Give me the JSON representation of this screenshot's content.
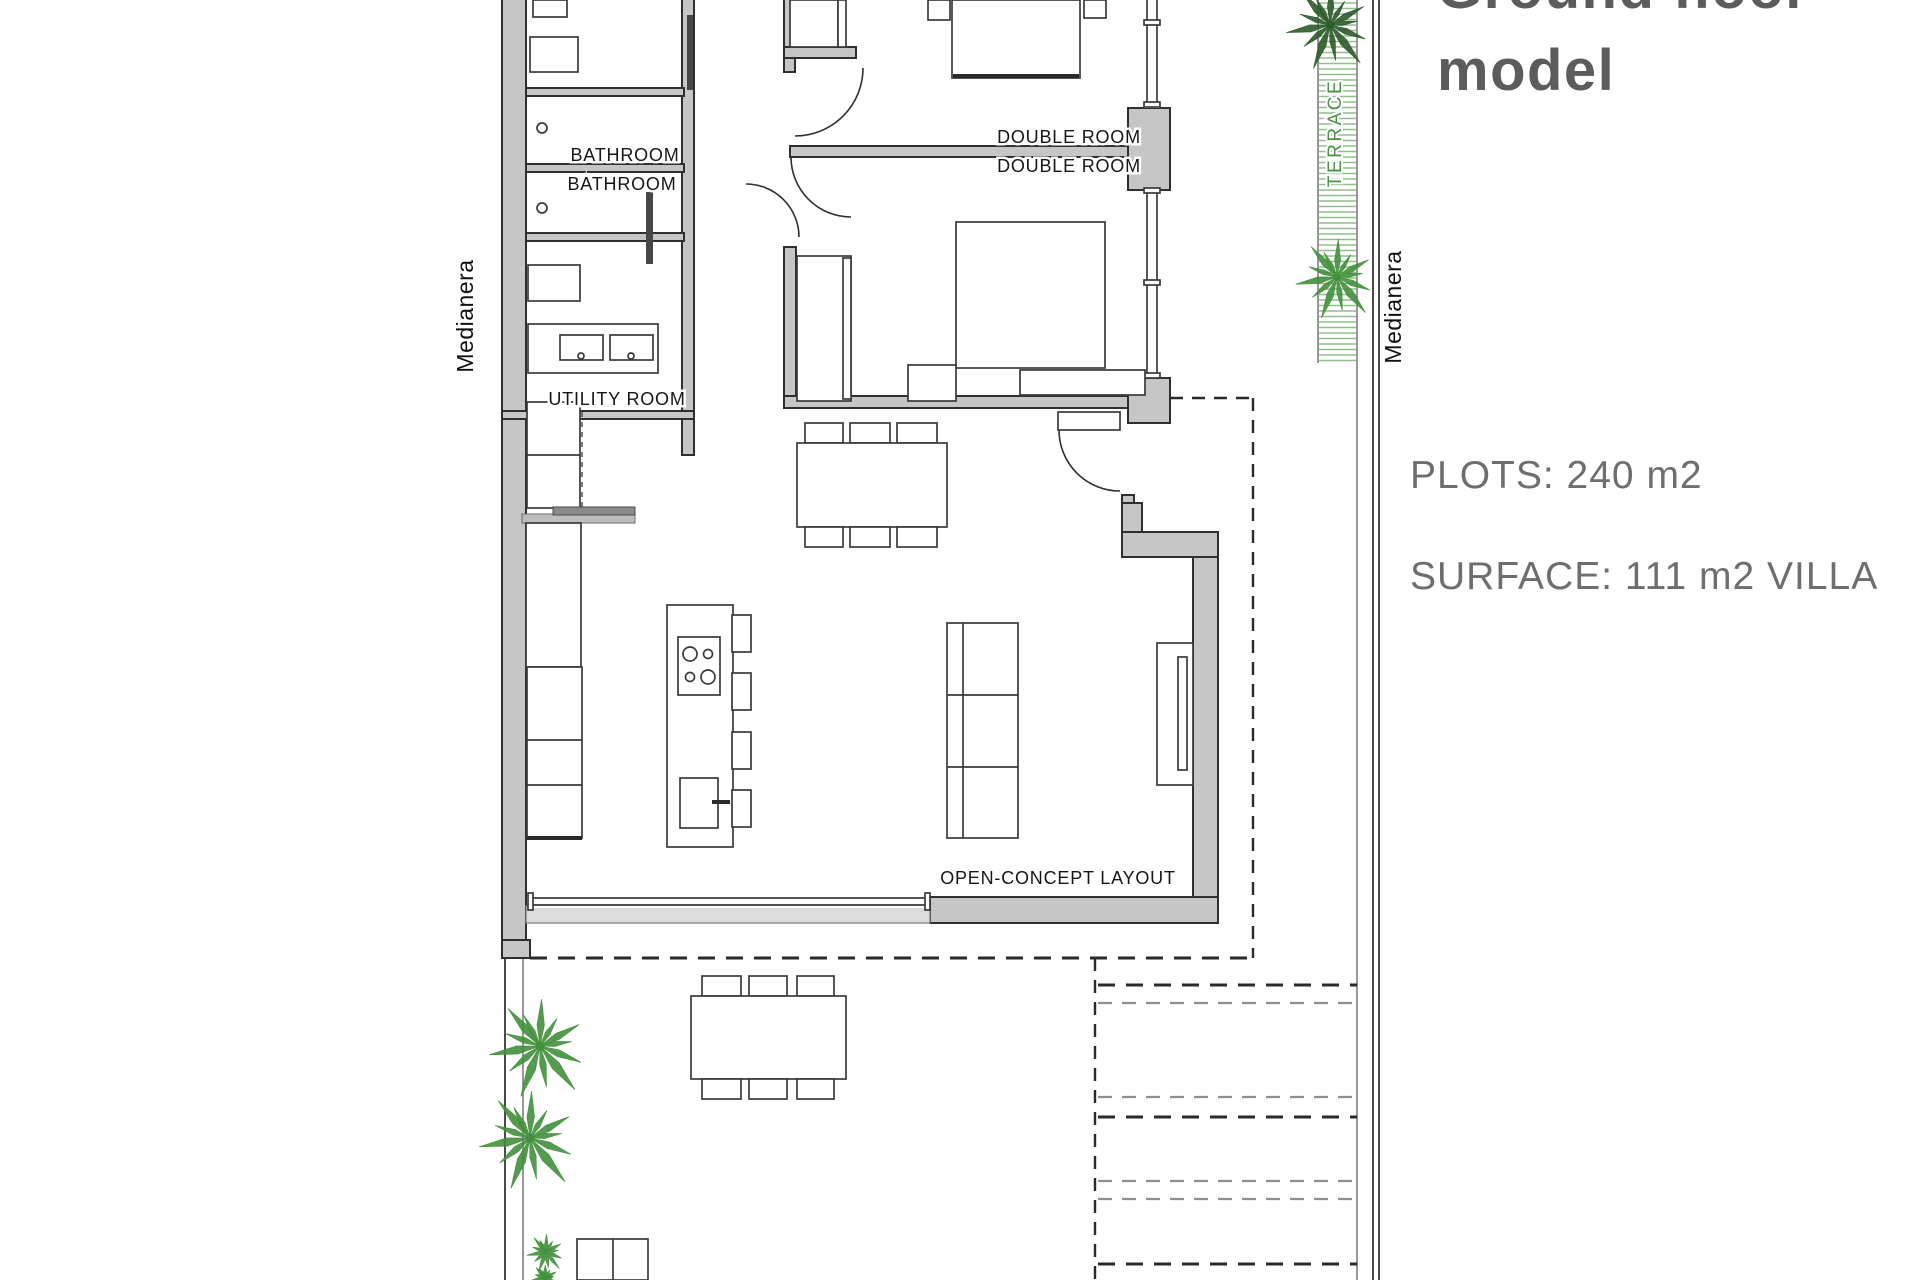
{
  "title": {
    "line1": "Ground floor",
    "line2": "model"
  },
  "info": {
    "plots": "PLOTS: 240 m2",
    "surface": "SURFACE: 111 m2 VILLA",
    "plot_area_m2": 240,
    "villa_surface_m2": 111
  },
  "rooms": {
    "bathroom1": "BATHROOM",
    "bathroom2": "BATHROOM",
    "utility": "UTILITY ROOM",
    "double1": "DOUBLE ROOM",
    "double2": "DOUBLE ROOM",
    "open_concept": "OPEN-CONCEPT LAYOUT",
    "terrace": "TERRACE"
  },
  "boundaries": {
    "left": "Medianera",
    "right": "Medianera"
  },
  "colors": {
    "wall_fill": "#c6c6c6",
    "line": "#2f2f2f",
    "text_gray": "#6e6e6e",
    "title_gray": "#5c5c5c",
    "hatch_green": "#92bd8c",
    "plant_green": "#43903c",
    "plant_dark_green": "#2c5a2a",
    "terrace_text": "#4d9147"
  }
}
